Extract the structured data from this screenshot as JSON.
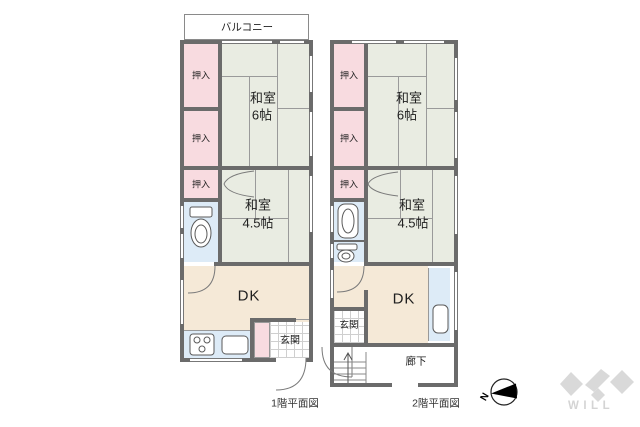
{
  "floor1": {
    "caption": "1階平面図",
    "balcony": "バルコニー",
    "closet1": "押入",
    "closet2": "押入",
    "closet3": "押入",
    "washitsu6_name": "和室",
    "washitsu6_size": "6帖",
    "washitsu45_name": "和室",
    "washitsu45_size": "4.5帖",
    "dk": "DK",
    "genkan": "玄関"
  },
  "floor2": {
    "caption": "2階平面図",
    "closet1": "押入",
    "closet2": "押入",
    "closet3": "押入",
    "washitsu6_name": "和室",
    "washitsu6_size": "6帖",
    "washitsu45_name": "和室",
    "washitsu45_size": "4.5帖",
    "dk": "DK",
    "genkan": "玄関",
    "corridor": "廊下"
  },
  "compass": {
    "north_label": "N"
  },
  "brand": {
    "logo_text": "WILL"
  },
  "colors": {
    "wall": "#6b6b6b",
    "tatami": "#e9ece2",
    "closet_pink": "#f8dbe0",
    "dk_beige": "#f5e9d7",
    "water_blue": "#ddebf7"
  }
}
